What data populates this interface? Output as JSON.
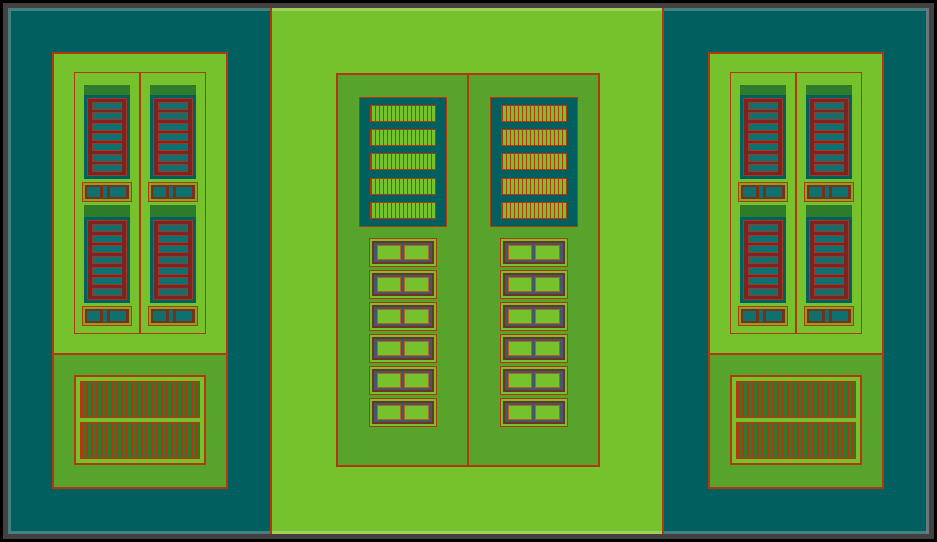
{
  "palette": {
    "border-black": "#000000",
    "frame-gray": "#454040",
    "teal-bg": "#015f5f",
    "teal-edge": "#44807f",
    "gray-edge": "#68787c",
    "green-bright": "#76c22d",
    "green-edge": "#9ed05b",
    "green-mid": "#58a32c",
    "green-dark": "#2f7b2c",
    "red-line": "#b3380f",
    "maroon": "#7b2421",
    "slot-edge": "#9c3a2a",
    "teal-slot": "#0e7170",
    "olive": "#8aa21f",
    "maroon-band": "#77301a",
    "slate": "#46566b",
    "widget-brown": "#6f3322",
    "square-border": "#b2621a"
  },
  "structure": {
    "side_cell": {
      "columns": 2,
      "finger_arrays_per_column": 2,
      "fingers_per_array": 7,
      "contact_bands_per_column": 2,
      "contact_pads_per_band": 2,
      "stripe_bars": 2
    },
    "center_cell": {
      "columns": 2,
      "hatch_bars": 5,
      "via_rows": 6,
      "pads_per_row": 2
    }
  }
}
